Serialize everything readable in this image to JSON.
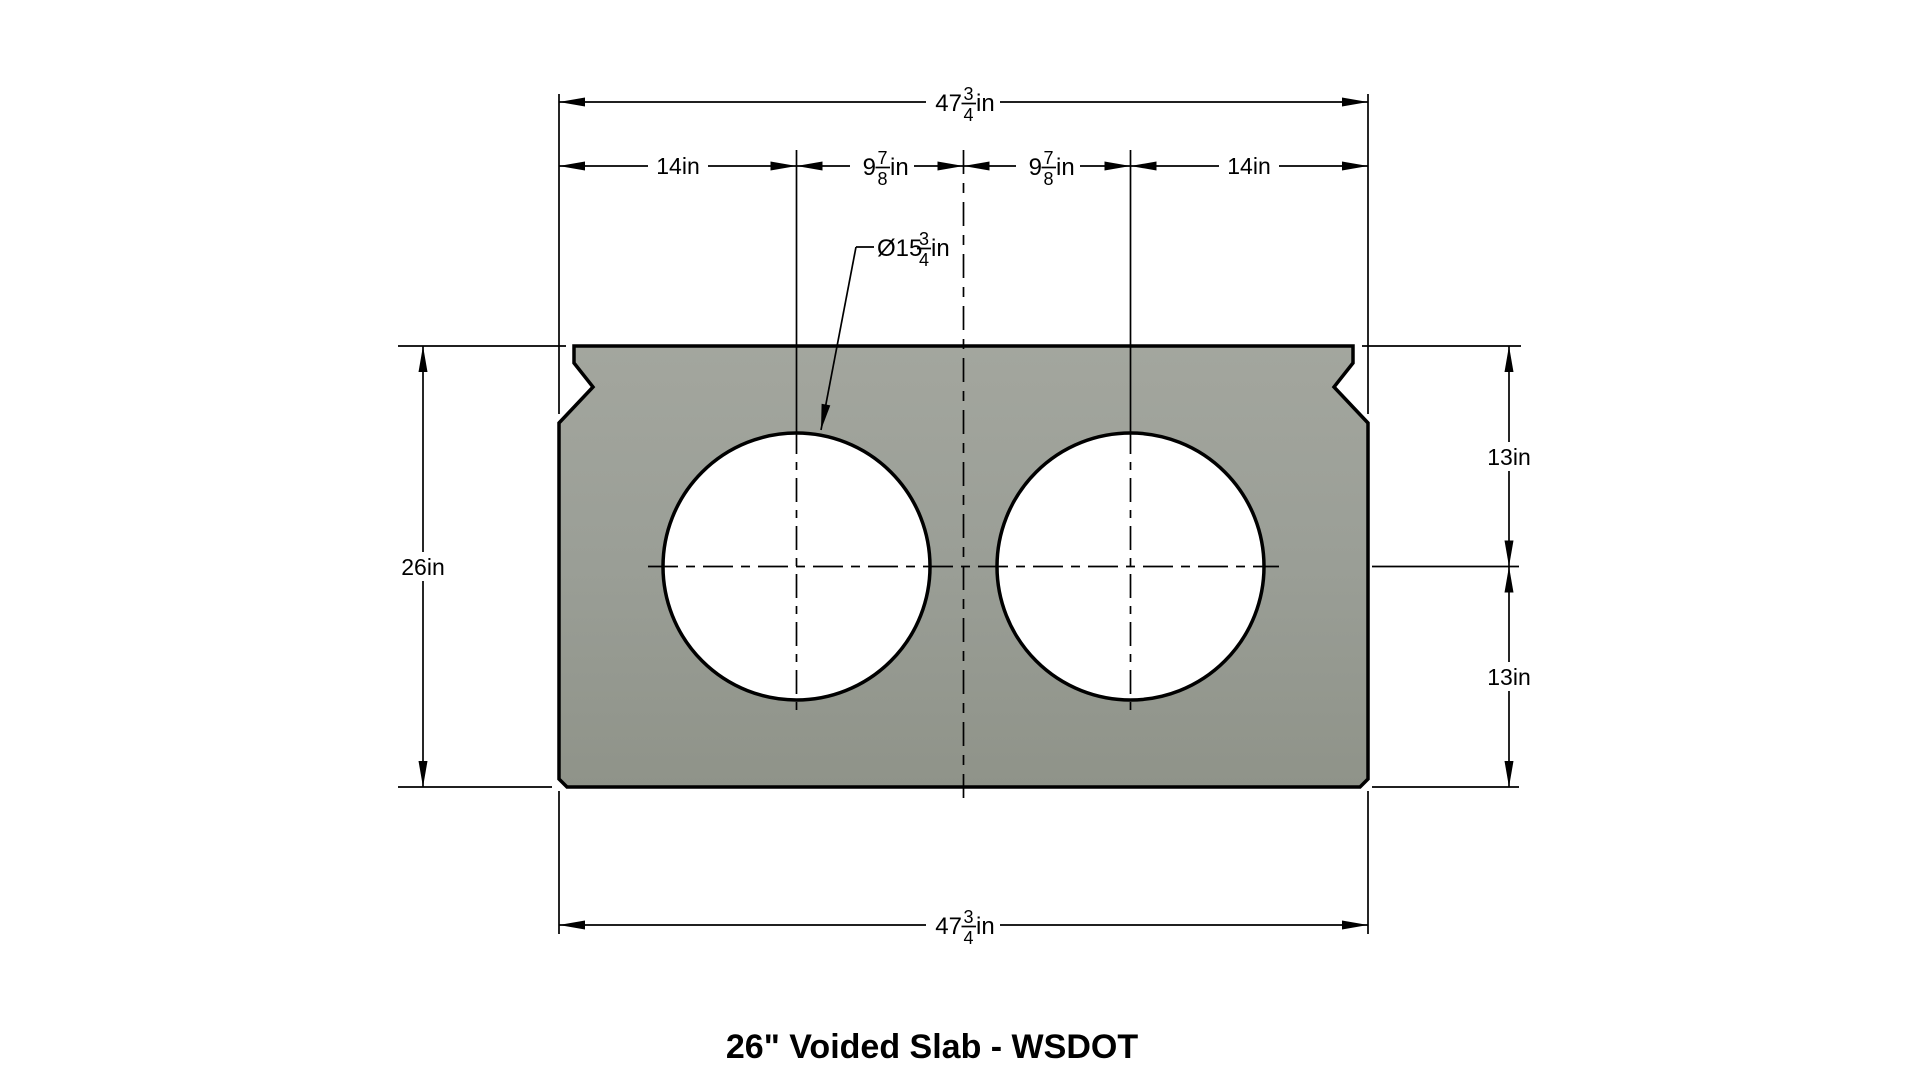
{
  "drawing": {
    "title": "26\" Voided Slab - WSDOT",
    "dims": {
      "width_top": {
        "whole": "47",
        "num": "3",
        "den": "4",
        "unit": "in"
      },
      "width_bottom": {
        "whole": "47",
        "num": "3",
        "den": "4",
        "unit": "in"
      },
      "seg_left": "14in",
      "seg_mid_left": {
        "whole": "9",
        "num": "7",
        "den": "8",
        "unit": "in"
      },
      "seg_mid_right": {
        "whole": "9",
        "num": "7",
        "den": "8",
        "unit": "in"
      },
      "seg_right": "14in",
      "height": "26in",
      "height_top_half": "13in",
      "height_bottom_half": "13in",
      "void_dia": {
        "whole": "Ø15",
        "num": "3",
        "den": "4",
        "unit": "in"
      }
    },
    "colors": {
      "slab_gray": "#9a9e96",
      "line": "#000000",
      "background": "#ffffff"
    }
  }
}
